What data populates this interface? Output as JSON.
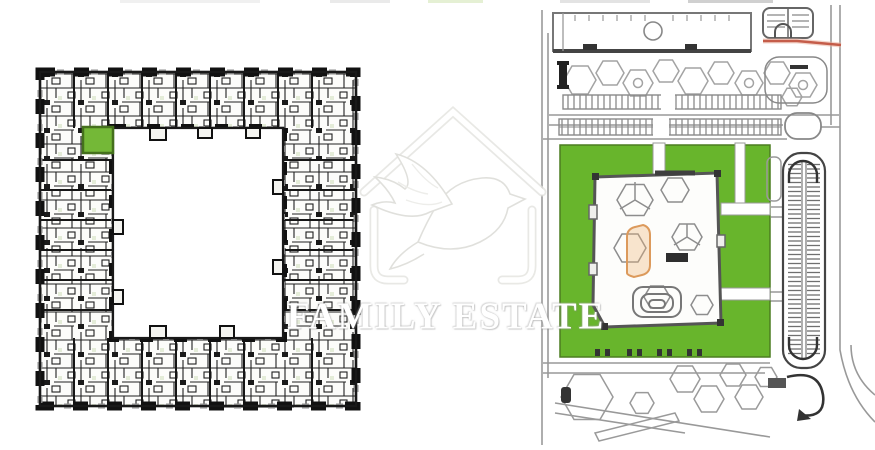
{
  "page": {
    "background": "#ffffff"
  },
  "watermark": {
    "text": "FAMILY ESTATE",
    "logo": "dove-in-house-logo",
    "color": "#ffffff"
  },
  "floor_plan": {
    "description": "courtyard apartment building floor plan",
    "highlighted_unit_color": "#74b837",
    "wall_color": "#1c1c1c",
    "balcony_color": "#8f8f8f",
    "plaza_color": "#9f9f9f"
  },
  "site_plan": {
    "description": "site master plan",
    "green_area_color": "#68b52c",
    "highlighted_building_color": "#e8b176",
    "red_route_color": "#c0503c",
    "road_color": "#8a8a8a",
    "dark_accent_color": "#333333"
  }
}
